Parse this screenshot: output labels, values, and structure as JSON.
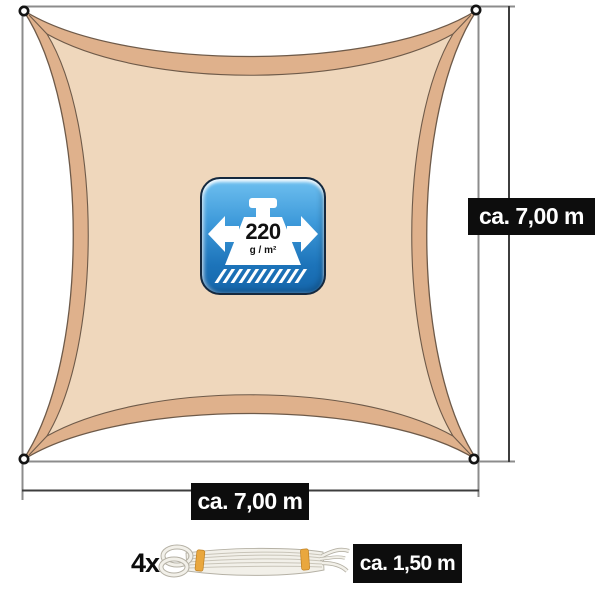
{
  "labels": {
    "height": "ca. 7,00 m",
    "width": "ca. 7,00 m",
    "rope_quantity": "4x",
    "rope_length": "ca. 1,50 m"
  },
  "badge": {
    "value": "220",
    "unit": "g / m²"
  },
  "icons": {
    "badge_left_arrow": "left-block-arrow-icon",
    "badge_right_arrow": "right-block-arrow-icon",
    "badge_weight": "weight-icon",
    "badge_surface": "hatched-surface-icon",
    "sail_corners": "grommet-ring-icon",
    "accessory": "rope-coil-icon"
  },
  "colors": {
    "sail_hem": "#dfb18c",
    "sail_inner": "#efd7bc",
    "sail_outline": "#6e5a49",
    "frame_line": "#8c8c8c",
    "dimension_line": "#3d3d3d",
    "label_bg": "#0d0d0d",
    "label_text": "#ffffff",
    "badge_blue_top": "#6fc0f0",
    "badge_blue_bottom": "#1566ab",
    "badge_border": "#15293f",
    "rope_body": "#f2f0e9",
    "rope_shade": "#b5b1a5",
    "rope_band": "#e9a73e"
  }
}
